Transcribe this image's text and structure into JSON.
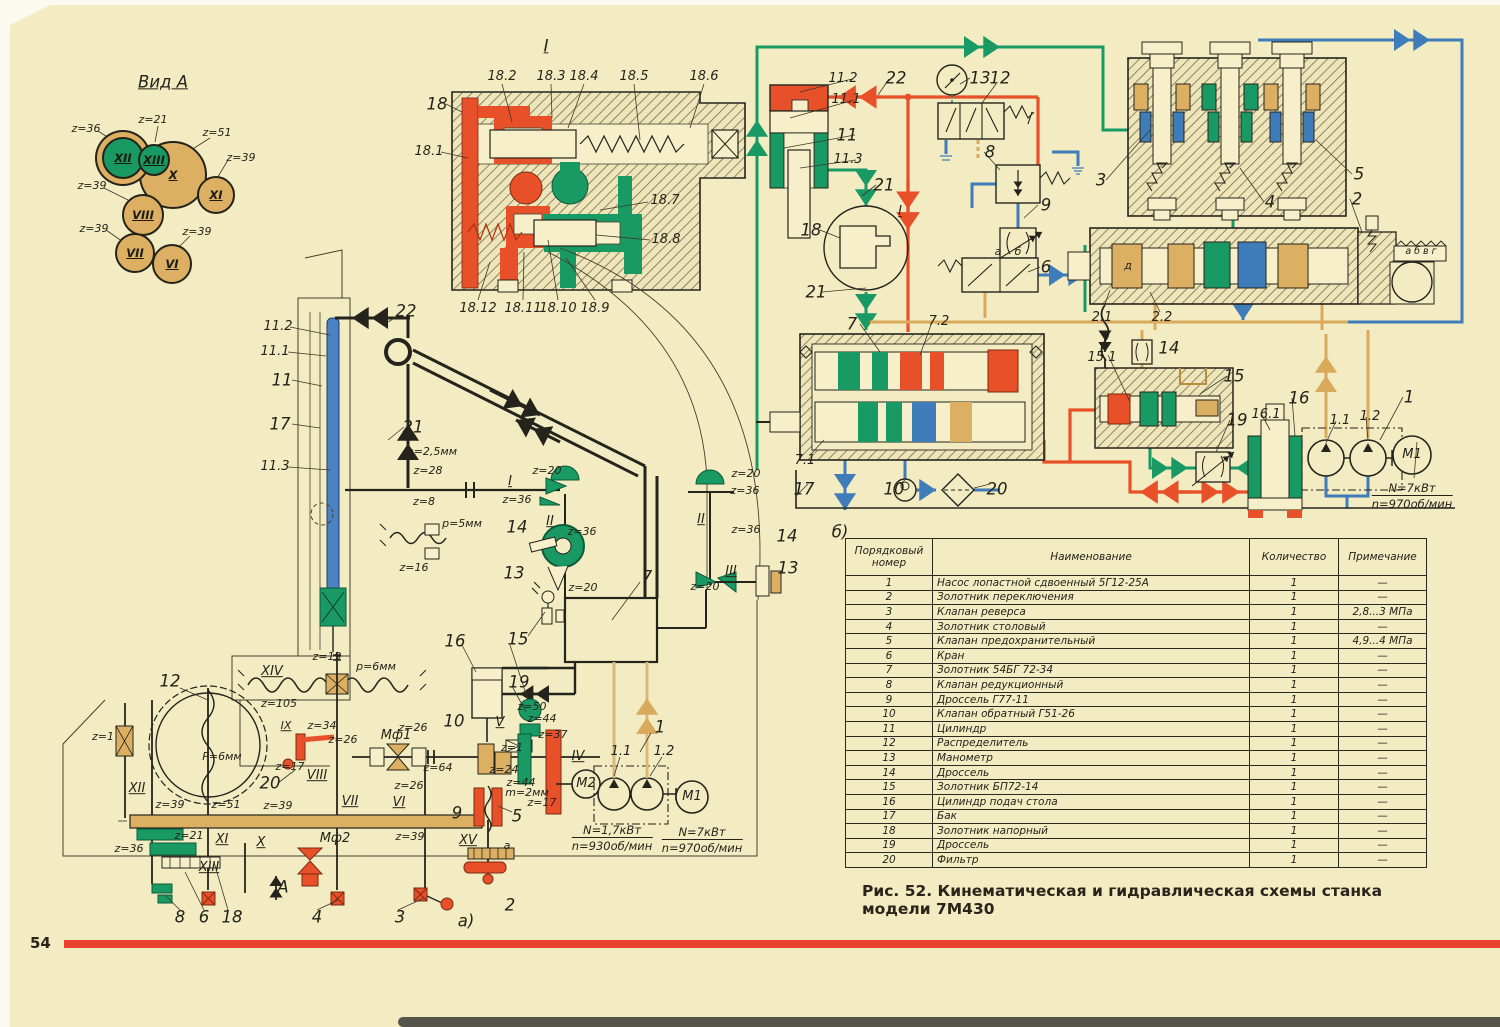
{
  "page": {
    "number": "54"
  },
  "caption": "Рис. 52. Кинематическая и гидравлическая схемы станка модели 7М430",
  "colors": {
    "paper": "#f3ecc2",
    "red": "#e8502a",
    "green": "#199a64",
    "blue": "#3f7cba",
    "tan": "#dcaf63",
    "black": "#24241c"
  },
  "gears": [
    {
      "id": "X",
      "x": 171,
      "y": 173,
      "r": 32,
      "fill": "#dcaf63",
      "ring": false
    },
    {
      "id": "XII",
      "x": 121,
      "y": 156,
      "r": 19,
      "fill": "#199a64",
      "ring": true
    },
    {
      "id": "XIII",
      "x": 152,
      "y": 158,
      "r": 14,
      "fill": "#199a64",
      "ring": false
    },
    {
      "id": "XI",
      "x": 214,
      "y": 193,
      "r": 17,
      "fill": "#dcaf63",
      "ring": false
    },
    {
      "id": "VIII",
      "x": 141,
      "y": 213,
      "r": 19,
      "fill": "#dcaf63",
      "ring": false
    },
    {
      "id": "VII",
      "x": 133,
      "y": 251,
      "r": 18,
      "fill": "#dcaf63",
      "ring": false
    },
    {
      "id": "VI",
      "x": 170,
      "y": 262,
      "r": 18,
      "fill": "#dcaf63",
      "ring": false
    }
  ],
  "labels": [
    {
      "t": "Вид А",
      "x": 163,
      "y": 82,
      "c": "u g",
      "n": "view-a-title"
    },
    {
      "t": "z=36",
      "x": 86,
      "y": 129,
      "c": "s"
    },
    {
      "t": "z=21",
      "x": 153,
      "y": 120,
      "c": "s"
    },
    {
      "t": "z=51",
      "x": 217,
      "y": 133,
      "c": "s"
    },
    {
      "t": "z=39",
      "x": 241,
      "y": 158,
      "c": "s"
    },
    {
      "t": "z=39",
      "x": 92,
      "y": 186,
      "c": "s"
    },
    {
      "t": "z=39",
      "x": 94,
      "y": 229,
      "c": "s"
    },
    {
      "t": "z=39",
      "x": 197,
      "y": 232,
      "c": "s"
    },
    {
      "t": "I",
      "x": 546,
      "y": 46,
      "c": "u g",
      "n": "detail-i-title"
    },
    {
      "t": "18.2",
      "x": 502,
      "y": 77
    },
    {
      "t": "18.3",
      "x": 551,
      "y": 77
    },
    {
      "t": "18.4",
      "x": 584,
      "y": 77
    },
    {
      "t": "18.5",
      "x": 634,
      "y": 77
    },
    {
      "t": "18.6",
      "x": 704,
      "y": 77
    },
    {
      "t": "18",
      "x": 437,
      "y": 104,
      "c": "g"
    },
    {
      "t": "18.1",
      "x": 429,
      "y": 152
    },
    {
      "t": "18.7",
      "x": 665,
      "y": 201
    },
    {
      "t": "18.8",
      "x": 666,
      "y": 240
    },
    {
      "t": "18.12",
      "x": 478,
      "y": 309
    },
    {
      "t": "18.11",
      "x": 523,
      "y": 309
    },
    {
      "t": "18.10",
      "x": 558,
      "y": 309
    },
    {
      "t": "18.9",
      "x": 595,
      "y": 309
    },
    {
      "t": "22",
      "x": 406,
      "y": 311,
      "c": "g"
    },
    {
      "t": "11.2",
      "x": 278,
      "y": 327
    },
    {
      "t": "11.1",
      "x": 275,
      "y": 352
    },
    {
      "t": "11",
      "x": 282,
      "y": 380,
      "c": "g"
    },
    {
      "t": "17",
      "x": 280,
      "y": 424,
      "c": "g"
    },
    {
      "t": "11.3",
      "x": 275,
      "y": 467
    },
    {
      "t": "21",
      "x": 413,
      "y": 427,
      "c": "g"
    },
    {
      "t": "m=2,5мм",
      "x": 430,
      "y": 452,
      "c": "s"
    },
    {
      "t": "z=28",
      "x": 428,
      "y": 471,
      "c": "s"
    },
    {
      "t": "z=8",
      "x": 424,
      "y": 502,
      "c": "s"
    },
    {
      "t": "I",
      "x": 510,
      "y": 482,
      "c": "u"
    },
    {
      "t": "z=20",
      "x": 547,
      "y": 471,
      "c": "s"
    },
    {
      "t": "z=36",
      "x": 517,
      "y": 500,
      "c": "s"
    },
    {
      "t": "II",
      "x": 550,
      "y": 522,
      "c": "u"
    },
    {
      "t": "14",
      "x": 517,
      "y": 527,
      "c": "g"
    },
    {
      "t": "z=36",
      "x": 582,
      "y": 532,
      "c": "s"
    },
    {
      "t": "13",
      "x": 514,
      "y": 573,
      "c": "g"
    },
    {
      "t": "z=20",
      "x": 583,
      "y": 588,
      "c": "s"
    },
    {
      "t": "p=5мм",
      "x": 462,
      "y": 524,
      "c": "s"
    },
    {
      "t": "z=16",
      "x": 414,
      "y": 568,
      "c": "s"
    },
    {
      "t": "z=20",
      "x": 746,
      "y": 474,
      "c": "s"
    },
    {
      "t": "z=36",
      "x": 745,
      "y": 491,
      "c": "s"
    },
    {
      "t": "II",
      "x": 701,
      "y": 520,
      "c": "u"
    },
    {
      "t": "z=36",
      "x": 746,
      "y": 530,
      "c": "s"
    },
    {
      "t": "14",
      "x": 787,
      "y": 536,
      "c": "g"
    },
    {
      "t": "III",
      "x": 731,
      "y": 572,
      "c": "u"
    },
    {
      "t": "13",
      "x": 788,
      "y": 568,
      "c": "g"
    },
    {
      "t": "z=20",
      "x": 705,
      "y": 587,
      "c": "s"
    },
    {
      "t": "7",
      "x": 647,
      "y": 577,
      "c": "g"
    },
    {
      "t": "15",
      "x": 518,
      "y": 639,
      "c": "g"
    },
    {
      "t": "16",
      "x": 455,
      "y": 641,
      "c": "g"
    },
    {
      "t": "19",
      "x": 519,
      "y": 682,
      "c": "g"
    },
    {
      "t": "12",
      "x": 170,
      "y": 681,
      "c": "g"
    },
    {
      "t": "XIV",
      "x": 272,
      "y": 672,
      "c": "u"
    },
    {
      "t": "z=19",
      "x": 327,
      "y": 657,
      "c": "s"
    },
    {
      "t": "p=6мм",
      "x": 376,
      "y": 667,
      "c": "s"
    },
    {
      "t": "z=105",
      "x": 279,
      "y": 704,
      "c": "s"
    },
    {
      "t": "z=1",
      "x": 103,
      "y": 737,
      "c": "s"
    },
    {
      "t": "IX",
      "x": 286,
      "y": 726,
      "c": "u s"
    },
    {
      "t": "z=34",
      "x": 322,
      "y": 726,
      "c": "s"
    },
    {
      "t": "z=26",
      "x": 343,
      "y": 740,
      "c": "s"
    },
    {
      "t": "Мф1",
      "x": 396,
      "y": 736
    },
    {
      "t": "z=26",
      "x": 413,
      "y": 728,
      "c": "s"
    },
    {
      "t": "10",
      "x": 454,
      "y": 721,
      "c": "g"
    },
    {
      "t": "P=6мм",
      "x": 222,
      "y": 757,
      "c": "s"
    },
    {
      "t": "z=17",
      "x": 290,
      "y": 767,
      "c": "s"
    },
    {
      "t": "20",
      "x": 270,
      "y": 783,
      "c": "g"
    },
    {
      "t": "VIII",
      "x": 317,
      "y": 776,
      "c": "u"
    },
    {
      "t": "z=64",
      "x": 438,
      "y": 768,
      "c": "s"
    },
    {
      "t": "XII",
      "x": 137,
      "y": 789,
      "c": "u"
    },
    {
      "t": "z=39",
      "x": 170,
      "y": 805,
      "c": "s"
    },
    {
      "t": "z=51",
      "x": 226,
      "y": 805,
      "c": "s"
    },
    {
      "t": "z=39",
      "x": 278,
      "y": 806,
      "c": "s"
    },
    {
      "t": "VII",
      "x": 350,
      "y": 802,
      "c": "u"
    },
    {
      "t": "VI",
      "x": 399,
      "y": 803,
      "c": "u"
    },
    {
      "t": "z=26",
      "x": 409,
      "y": 786,
      "c": "s"
    },
    {
      "t": "9",
      "x": 457,
      "y": 813,
      "c": "g"
    },
    {
      "t": "z=36",
      "x": 129,
      "y": 849,
      "c": "s"
    },
    {
      "t": "z=21",
      "x": 189,
      "y": 836,
      "c": "s"
    },
    {
      "t": "XI",
      "x": 222,
      "y": 840,
      "c": "u"
    },
    {
      "t": "X",
      "x": 261,
      "y": 843,
      "c": "u"
    },
    {
      "t": "Мф2",
      "x": 335,
      "y": 839
    },
    {
      "t": "z=39",
      "x": 410,
      "y": 837,
      "c": "s"
    },
    {
      "t": "XV",
      "x": 468,
      "y": 841,
      "c": "u"
    },
    {
      "t": "XIII",
      "x": 209,
      "y": 868,
      "c": "u"
    },
    {
      "t": "8",
      "x": 180,
      "y": 917,
      "c": "g"
    },
    {
      "t": "6",
      "x": 204,
      "y": 917,
      "c": "g"
    },
    {
      "t": "18",
      "x": 232,
      "y": 917,
      "c": "g"
    },
    {
      "t": "A",
      "x": 283,
      "y": 887,
      "c": "g"
    },
    {
      "t": "4",
      "x": 317,
      "y": 917,
      "c": "g"
    },
    {
      "t": "3",
      "x": 400,
      "y": 917,
      "c": "g"
    },
    {
      "t": "а)",
      "x": 466,
      "y": 921,
      "c": "g",
      "n": "scheme-a-label"
    },
    {
      "t": "z=50",
      "x": 532,
      "y": 707,
      "c": "s"
    },
    {
      "t": "z=44",
      "x": 542,
      "y": 719,
      "c": "s"
    },
    {
      "t": "V",
      "x": 500,
      "y": 723,
      "c": "u"
    },
    {
      "t": "z=37",
      "x": 553,
      "y": 735,
      "c": "s"
    },
    {
      "t": "z=1",
      "x": 512,
      "y": 748,
      "c": "s"
    },
    {
      "t": "z=24",
      "x": 504,
      "y": 770,
      "c": "s"
    },
    {
      "t": "IV",
      "x": 578,
      "y": 757,
      "c": "u"
    },
    {
      "t": "z=44",
      "x": 521,
      "y": 783,
      "c": "s"
    },
    {
      "t": "m=2мм",
      "x": 527,
      "y": 793,
      "c": "s"
    },
    {
      "t": "z=17",
      "x": 542,
      "y": 803,
      "c": "s"
    },
    {
      "t": "1.1",
      "x": 621,
      "y": 752
    },
    {
      "t": "1",
      "x": 660,
      "y": 727,
      "c": "g"
    },
    {
      "t": "1.2",
      "x": 664,
      "y": 752
    },
    {
      "t": "5",
      "x": 517,
      "y": 816,
      "c": "g"
    },
    {
      "t": "a",
      "x": 507,
      "y": 846,
      "c": "s"
    },
    {
      "t": "2",
      "x": 510,
      "y": 905,
      "c": "g"
    },
    {
      "t": "М2",
      "x": 586,
      "y": 784,
      "n": "motor-m2-label"
    },
    {
      "t": "М1",
      "x": 692,
      "y": 797,
      "n": "motor-m1-label"
    },
    {
      "t": "N=1,7кВт",
      "t2": "n=930об/мин",
      "x": 612,
      "y": 838,
      "n": "motor-m2-spec"
    },
    {
      "t": "N=7кВт",
      "t2": "n=970об/мин",
      "x": 702,
      "y": 840,
      "n": "motor-m1-spec"
    },
    {
      "t": "11.2",
      "x": 843,
      "y": 79
    },
    {
      "t": "22",
      "x": 896,
      "y": 78,
      "c": "g"
    },
    {
      "t": "11.1",
      "x": 846,
      "y": 100
    },
    {
      "t": "11",
      "x": 847,
      "y": 135,
      "c": "g"
    },
    {
      "t": "11.3",
      "x": 848,
      "y": 160
    },
    {
      "t": "21",
      "x": 884,
      "y": 185,
      "c": "g"
    },
    {
      "t": "13",
      "x": 980,
      "y": 78,
      "c": "g"
    },
    {
      "t": "12",
      "x": 1000,
      "y": 78,
      "c": "g"
    },
    {
      "t": "8",
      "x": 990,
      "y": 152,
      "c": "g"
    },
    {
      "t": "9",
      "x": 1046,
      "y": 205,
      "c": "g"
    },
    {
      "t": "3",
      "x": 1101,
      "y": 180,
      "c": "g"
    },
    {
      "t": "I",
      "x": 900,
      "y": 212,
      "c": "u"
    },
    {
      "t": "18",
      "x": 811,
      "y": 230,
      "c": "g"
    },
    {
      "t": "21",
      "x": 816,
      "y": 292,
      "c": "g"
    },
    {
      "t": "6",
      "x": 1046,
      "y": 267,
      "c": "g"
    },
    {
      "t": "а",
      "x": 998,
      "y": 252,
      "c": "s"
    },
    {
      "t": "б",
      "x": 1018,
      "y": 252,
      "c": "s"
    },
    {
      "t": "5",
      "x": 1359,
      "y": 174,
      "c": "g"
    },
    {
      "t": "4",
      "x": 1270,
      "y": 202,
      "c": "g"
    },
    {
      "t": "2",
      "x": 1357,
      "y": 199,
      "c": "g"
    },
    {
      "t": "а б в г",
      "x": 1421,
      "y": 252,
      "c": "xs"
    },
    {
      "t": "д",
      "x": 1128,
      "y": 266,
      "c": "s"
    },
    {
      "t": "2.1",
      "x": 1102,
      "y": 318
    },
    {
      "t": "2.2",
      "x": 1162,
      "y": 318
    },
    {
      "t": "7",
      "x": 852,
      "y": 324,
      "c": "g"
    },
    {
      "t": "7.2",
      "x": 939,
      "y": 322
    },
    {
      "t": "7.1",
      "x": 805,
      "y": 461
    },
    {
      "t": "17",
      "x": 804,
      "y": 489,
      "c": "g"
    },
    {
      "t": "10",
      "x": 894,
      "y": 489,
      "c": "g"
    },
    {
      "t": "20",
      "x": 997,
      "y": 489,
      "c": "g"
    },
    {
      "t": "15.1",
      "x": 1102,
      "y": 358
    },
    {
      "t": "15",
      "x": 1234,
      "y": 376,
      "c": "g"
    },
    {
      "t": "14",
      "x": 1169,
      "y": 348,
      "c": "g"
    },
    {
      "t": "19",
      "x": 1237,
      "y": 420,
      "c": "g"
    },
    {
      "t": "16.1",
      "x": 1266,
      "y": 415
    },
    {
      "t": "16",
      "x": 1299,
      "y": 398,
      "c": "g"
    },
    {
      "t": "1.1",
      "x": 1340,
      "y": 421
    },
    {
      "t": "1.2",
      "x": 1370,
      "y": 417
    },
    {
      "t": "1",
      "x": 1409,
      "y": 397,
      "c": "g"
    },
    {
      "t": "М1",
      "x": 1412,
      "y": 455,
      "n": "pump-motor-m1-label"
    },
    {
      "t": "N=7кВт",
      "t2": "n=970об/мин",
      "x": 1412,
      "y": 496,
      "n": "pump-motor-m1-spec"
    },
    {
      "t": "б)",
      "x": 840,
      "y": 532,
      "c": "g",
      "n": "scheme-b-label"
    }
  ],
  "table": {
    "headers": [
      "Порядковый номер",
      "Наименование",
      "Количество",
      "Примечание"
    ],
    "rows": [
      [
        "1",
        "Насос лопастной сдвоенный 5Г12-25А",
        "1",
        "—"
      ],
      [
        "2",
        "Золотник переключения",
        "1",
        "—"
      ],
      [
        "3",
        "Клапан реверса",
        "1",
        "2,8...3 МПа"
      ],
      [
        "4",
        "Золотник столовый",
        "1",
        "—"
      ],
      [
        "5",
        "Клапан предохранительный",
        "1",
        "4,9...4 МПа"
      ],
      [
        "6",
        "Кран",
        "1",
        "—"
      ],
      [
        "7",
        "Золотник 54БГ 72-34",
        "1",
        "—"
      ],
      [
        "8",
        "Клапан редукционный",
        "1",
        "—"
      ],
      [
        "9",
        "Дроссель Г77-11",
        "1",
        "—"
      ],
      [
        "10",
        "Клапан обратный Г51-26",
        "1",
        "—"
      ],
      [
        "11",
        "Цилиндр",
        "1",
        "—"
      ],
      [
        "12",
        "Распределитель",
        "1",
        "—"
      ],
      [
        "13",
        "Манометр",
        "1",
        "—"
      ],
      [
        "14",
        "Дроссель",
        "1",
        "—"
      ],
      [
        "15",
        "Золотник БП72-14",
        "1",
        "—"
      ],
      [
        "16",
        "Цилиндр подач стола",
        "1",
        "—"
      ],
      [
        "17",
        "Бак",
        "1",
        "—"
      ],
      [
        "18",
        "Золотник напорный",
        "1",
        "—"
      ],
      [
        "19",
        "Дроссель",
        "1",
        "—"
      ],
      [
        "20",
        "Фильтр",
        "1",
        "—"
      ]
    ]
  }
}
